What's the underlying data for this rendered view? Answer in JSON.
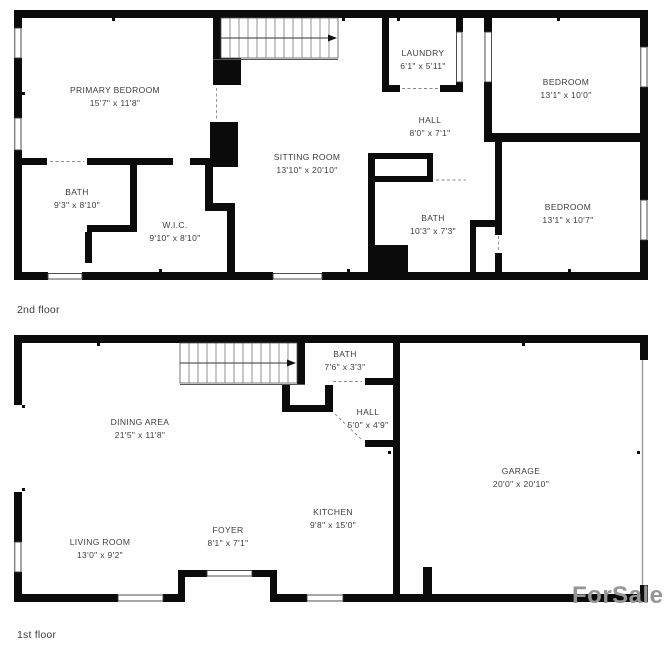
{
  "floors": {
    "second": {
      "label": "2nd floor",
      "rooms": {
        "primary_bedroom": {
          "name": "PRIMARY BEDROOM",
          "dims": "15'7\" x 11'8\""
        },
        "bath_left": {
          "name": "BATH",
          "dims": "9'3\" x 8'10\""
        },
        "wic": {
          "name": "W.I.C.",
          "dims": "9'10\" x 8'10\""
        },
        "sitting_room": {
          "name": "SITTING ROOM",
          "dims": "13'10\" x 20'10\""
        },
        "laundry": {
          "name": "LAUNDRY",
          "dims": "6'1\" x 5'11\""
        },
        "hall": {
          "name": "HALL",
          "dims": "8'0\" x 7'1\""
        },
        "bedroom_top": {
          "name": "BEDROOM",
          "dims": "13'1\" x 10'0\""
        },
        "bath_middle": {
          "name": "BATH",
          "dims": "10'3\" x 7'3\""
        },
        "bedroom_bottom": {
          "name": "BEDROOM",
          "dims": "13'1\" x 10'7\""
        }
      }
    },
    "first": {
      "label": "1st floor",
      "rooms": {
        "dining_area": {
          "name": "DINING AREA",
          "dims": "21'5\" x 11'8\""
        },
        "bath": {
          "name": "BATH",
          "dims": "7'6\" x 3'3\""
        },
        "hall": {
          "name": "HALL",
          "dims": "5'0\" x 4'9\""
        },
        "garage": {
          "name": "GARAGE",
          "dims": "20'0\" x 20'10\""
        },
        "kitchen": {
          "name": "KITCHEN",
          "dims": "9'8\" x 15'0\""
        },
        "foyer": {
          "name": "FOYER",
          "dims": "8'1\" x 7'1\""
        },
        "living_room": {
          "name": "LIVING ROOM",
          "dims": "13'0\" x 9'2\""
        }
      }
    }
  },
  "watermark": "ForSale",
  "colors": {
    "wall": "#0b0b0b",
    "label_text": "#3d3d3d",
    "watermark": "#969696"
  }
}
